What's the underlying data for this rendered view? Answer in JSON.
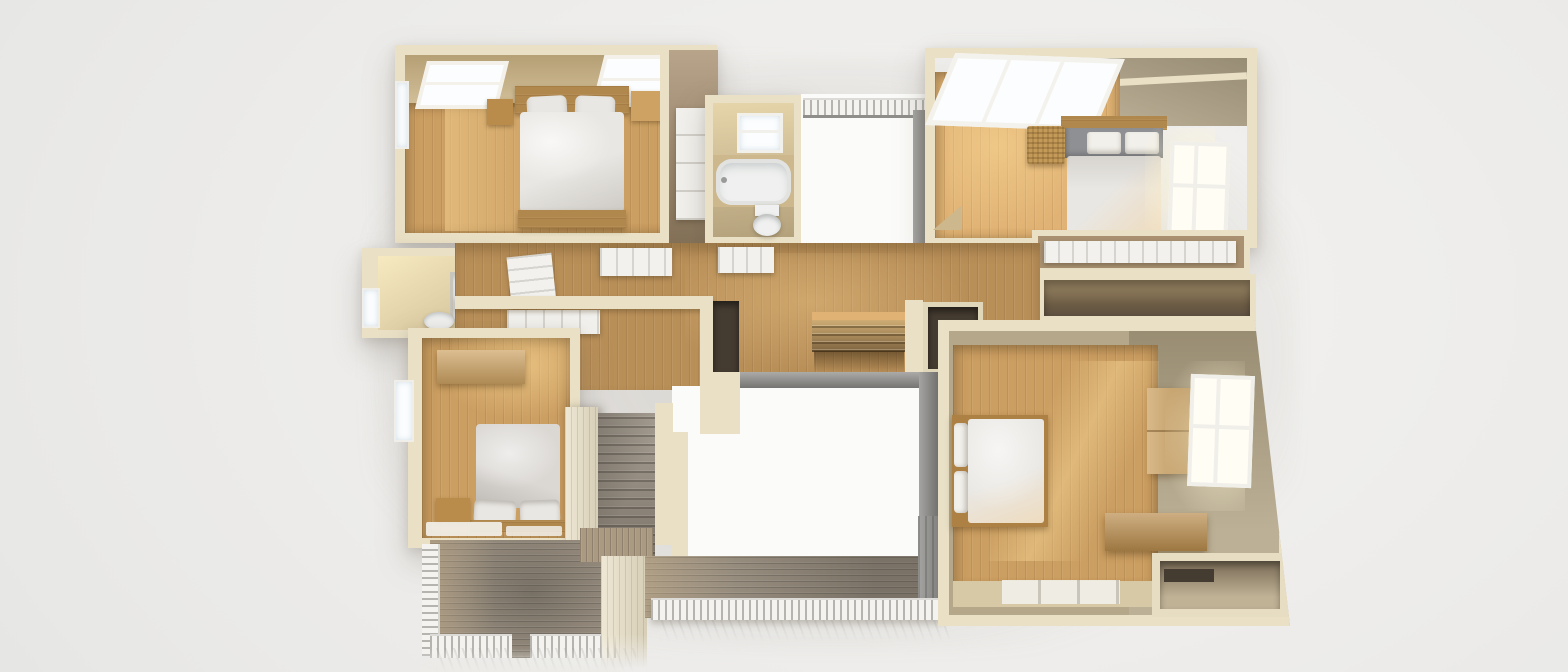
{
  "palette": {
    "background": "#ebeae8",
    "wall_cut": "#e9e0c6",
    "wall_cut_shadow": "#d7ccae",
    "wall_tan": "#cdb88d",
    "wall_tan_light": "#e8d5a8",
    "wall_tan_dark": "#a89070",
    "wall_gray_tan": "#b4a78a",
    "floor_wood": "#cb9e61",
    "floor_wood_light": "#e0b273",
    "floor_hall": "#b98f58",
    "floor_beige": "#d7c8a6",
    "stair_wood": "#caa066",
    "deck_gray": "#968c7e",
    "deck_gray_dark": "#7a756c",
    "deck_warm": "#aa9a82",
    "rail_white": "#f4f3f0",
    "void_white": "#fbfbf9",
    "glass": "#fbfdfe",
    "glass_warm": "#fffdf4",
    "frame_white": "#f2f0ea",
    "door_white": "#f2f1ed",
    "bedding_white": "#e9e7e3",
    "bedding_gray": "#dbd8d4",
    "headboard_wood": "#b0874c",
    "headboard_gray": "#8f9093",
    "furniture_wood": "#b98c4c",
    "furniture_wood_light": "#cda262",
    "wicker": "#c39a58",
    "fixture_white": "#eff0ef",
    "dark_opening": "#453c31",
    "gray_wall": "#8f8e8b"
  },
  "scene": {
    "type": "3d-floor-plan-render",
    "view": "top-down-dollhouse",
    "floor_shown": "upper-floor",
    "regions": [
      {
        "name": "bedroom-upper-left",
        "floor": "wood",
        "features": [
          "double-bed",
          "two-nightstands",
          "two-skylights",
          "left-window",
          "reach-in-closet"
        ]
      },
      {
        "name": "bathroom-upper-middle",
        "floor": "wood",
        "features": [
          "bathtub",
          "toilet",
          "window"
        ]
      },
      {
        "name": "open-void-upper",
        "features": [
          "slat-railing",
          "gray-partition-wall"
        ]
      },
      {
        "name": "bedroom-upper-right",
        "floor": "wood",
        "features": [
          "double-bed",
          "large-skylight",
          "right-window",
          "wicker-basket"
        ]
      },
      {
        "name": "hallway-center",
        "floor": "wood",
        "features": [
          "staircase-down",
          "open-door-panels",
          "dark-closet-openings"
        ]
      },
      {
        "name": "bathroom-middle-left",
        "features": [
          "shower-tray",
          "toilet",
          "window"
        ]
      },
      {
        "name": "closets-middle-right",
        "features": [
          "sliding-door-closet",
          "open-dark-closet"
        ]
      },
      {
        "name": "bedroom-lower-left",
        "floor": "wood",
        "features": [
          "double-bed",
          "dresser",
          "nightstand",
          "left-window",
          "white-rug"
        ]
      },
      {
        "name": "bedroom-lower-right",
        "floor": "wood",
        "features": [
          "double-bed",
          "wardrobe",
          "storage-chest",
          "right-window",
          "white-rug",
          "storage-nook"
        ]
      },
      {
        "name": "courtyard-void-center",
        "features": [
          "open-to-below",
          "gray-deck-edge"
        ]
      },
      {
        "name": "deck-lower-left",
        "features": [
          "white-railing",
          "exterior-stairs",
          "plank-decking"
        ]
      },
      {
        "name": "balcony-lower",
        "features": [
          "white-railing",
          "plank-decking",
          "gray-end-wall"
        ]
      }
    ]
  }
}
